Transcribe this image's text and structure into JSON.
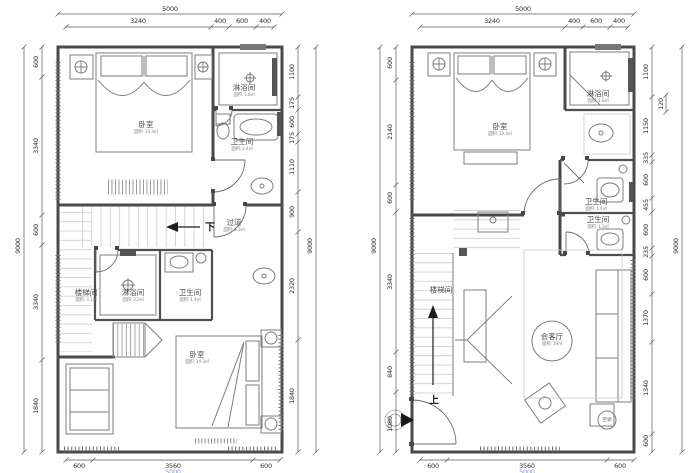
{
  "drawing": {
    "left_plan": {
      "dims": {
        "top_total": "5000",
        "top_segments": [
          "3240",
          "400",
          "600",
          "400"
        ],
        "left_total": "9000",
        "left_segments": [
          "600",
          "3340",
          "600",
          "3340",
          "1840"
        ],
        "right_segments": [
          "1100",
          "175",
          "600",
          "175",
          "1110",
          "900",
          "2320",
          "1840"
        ],
        "right_total": "9000",
        "bottom_segments": [
          "600",
          "3560",
          "600"
        ],
        "bottom_total": "5000"
      },
      "labels": {
        "bedroom_top": {
          "name": "卧室",
          "area": "面积: 13.3㎡"
        },
        "shower_top": {
          "name": "淋浴间",
          "area": "面积: 1.8㎡"
        },
        "bath_top": {
          "name": "卫生间",
          "area": "面积: 2.4㎡"
        },
        "corridor": {
          "name": "过道",
          "area": "面积: 2.3㎡"
        },
        "down": "下",
        "stair": {
          "name": "楼梯间",
          "area": "面积: 3.1㎡"
        },
        "shower_mid": {
          "name": "淋浴间",
          "area": "面积: 2.2㎡"
        },
        "bath_mid": {
          "name": "卫生间",
          "area": "面积: 1.4㎡"
        },
        "bedroom_bottom": {
          "name": "卧室",
          "area": "面积: 14.3㎡"
        }
      }
    },
    "right_plan": {
      "dims": {
        "top_total": "5000",
        "top_segments": [
          "3240",
          "400",
          "600",
          "400"
        ],
        "left_total": "9000",
        "left_segments": [
          "600",
          "2140",
          "600",
          "3340",
          "840",
          "1080"
        ],
        "right_segments": [
          "1100",
          "1150",
          "335",
          "600",
          "455",
          "600",
          "235",
          "600",
          "1370",
          "1340",
          "600"
        ],
        "right_outer": "120",
        "right_total": "9000",
        "bottom_segments": [
          "600",
          "3560",
          "600"
        ],
        "bottom_total": "5000"
      },
      "labels": {
        "bedroom": {
          "name": "卧室",
          "area": "面积: 13.3㎡"
        },
        "shower": {
          "name": "淋浴间",
          "area": "面积: 1.8㎡"
        },
        "bath_1": {
          "name": "卫生间",
          "area": "面积: 1.4㎡"
        },
        "bath_2": {
          "name": "卫生间",
          "area": "面积: 1.3㎡"
        },
        "stair": {
          "name": "楼梯间"
        },
        "living": {
          "name": "会客厅",
          "area": "面积: 19㎡"
        },
        "up": "上",
        "ac": "空调"
      }
    }
  }
}
